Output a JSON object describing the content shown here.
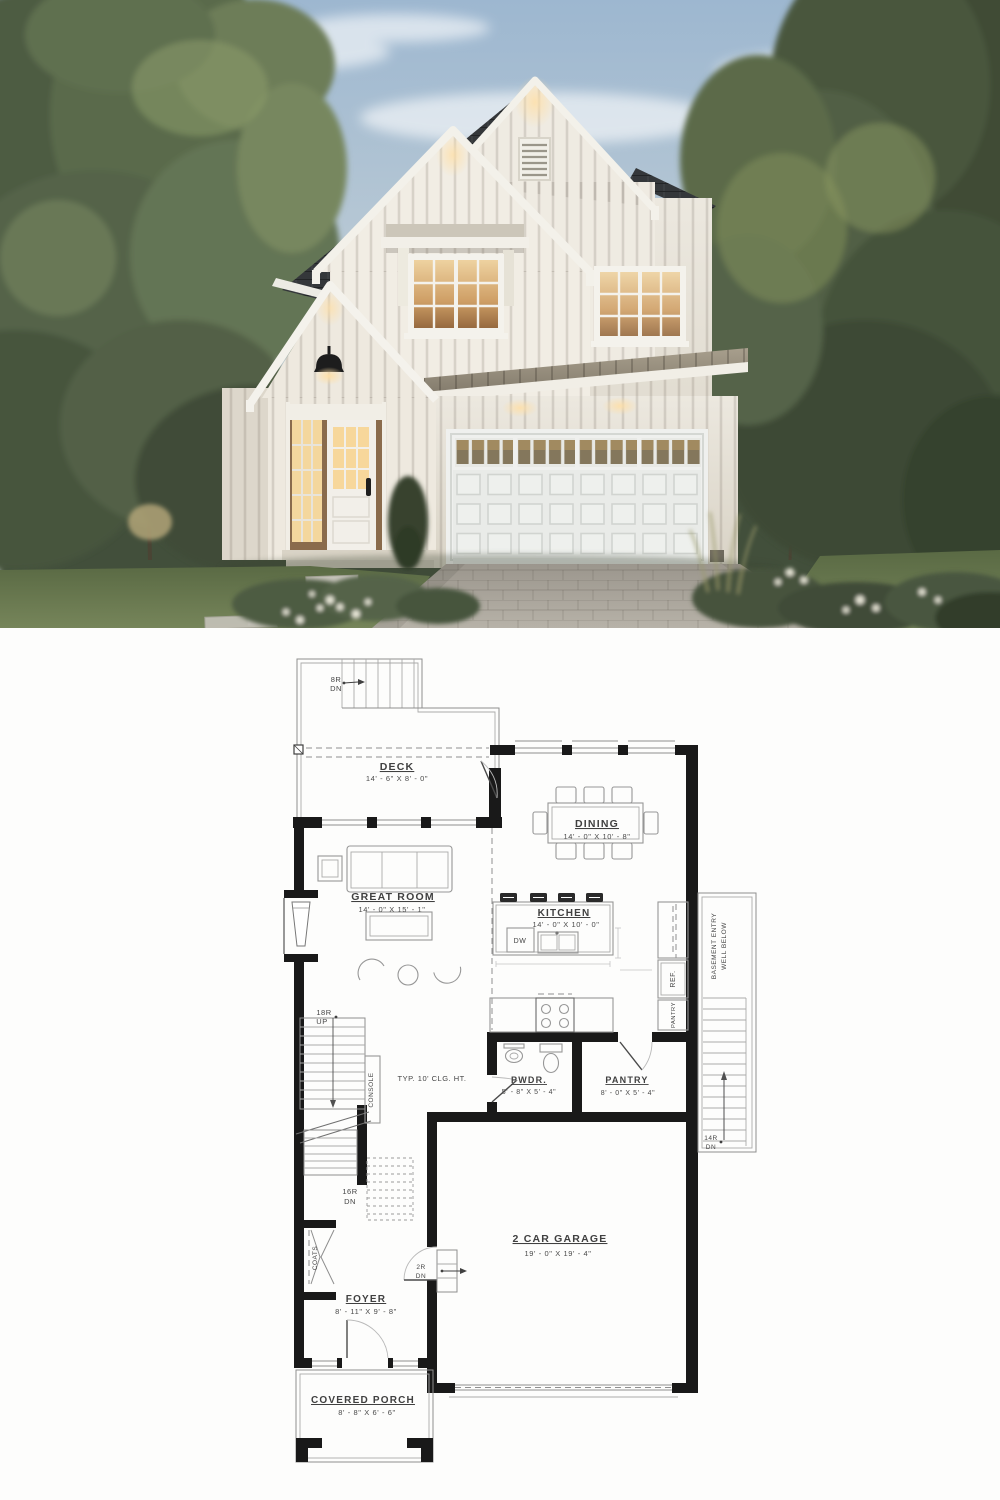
{
  "image_type": "house-plan-pin",
  "photo": {
    "description": "two-story white board-and-batten modern farmhouse at dusk",
    "colors": {
      "sky": "#a3bbd2",
      "siding": "#e9e5dc",
      "trim": "#f3f1ea",
      "dark_roof": "#34373a",
      "metal_roof": "#978f7e",
      "window_glow": "#e3bd85",
      "foliage": "#4e5c42",
      "lawn": "#66764b",
      "driveway": "#a8a39a",
      "garage_door": "#eff0ee"
    }
  },
  "floor_plan": {
    "colors": {
      "wall": "#191919",
      "line": "#8e8e8e",
      "text": "#404040"
    },
    "rooms": {
      "deck": {
        "name": "DECK",
        "dims": "14' - 6\" X 8' - 0\""
      },
      "dining": {
        "name": "DINING",
        "dims": "14' - 0\" X 10' - 8\""
      },
      "great_room": {
        "name": "GREAT ROOM",
        "dims": "14' - 0\" X 15' - 1\""
      },
      "kitchen": {
        "name": "KITCHEN",
        "dims": "14' - 0\" X 10' - 0\""
      },
      "powder": {
        "name": "PWDR.",
        "dims": "5' - 8\" X 5' - 4\""
      },
      "pantry": {
        "name": "PANTRY",
        "dims": "8' - 0\" X 5' - 4\""
      },
      "garage": {
        "name": "2 CAR GARAGE",
        "dims": "19' - 0\" X 19' - 4\""
      },
      "foyer": {
        "name": "FOYER",
        "dims": "8' - 11\" X 9' - 8\""
      },
      "porch": {
        "name": "COVERED PORCH",
        "dims": "8' - 8\" X 6' - 6\""
      }
    },
    "stairs": {
      "deck_stairs": {
        "l1": "8R",
        "l2": "DN"
      },
      "main_up": {
        "l1": "18R",
        "l2": "UP"
      },
      "basement_dn": {
        "l1": "16R",
        "l2": "DN"
      },
      "garage_steps": {
        "l1": "2R",
        "l2": "DN"
      },
      "entry_well_dn": {
        "l1": "14R",
        "l2": "DN"
      }
    },
    "annotations": {
      "ceiling": "TYP. 10' CLG. HT.",
      "console": "CONSOLE",
      "coats": "COATS",
      "fridge": "REF.",
      "dishwasher": "DW",
      "pantry_cabinet": "PANTRY",
      "basement_entry_line1": "BASEMENT ENTRY",
      "basement_entry_line2": "WELL BELOW"
    }
  }
}
